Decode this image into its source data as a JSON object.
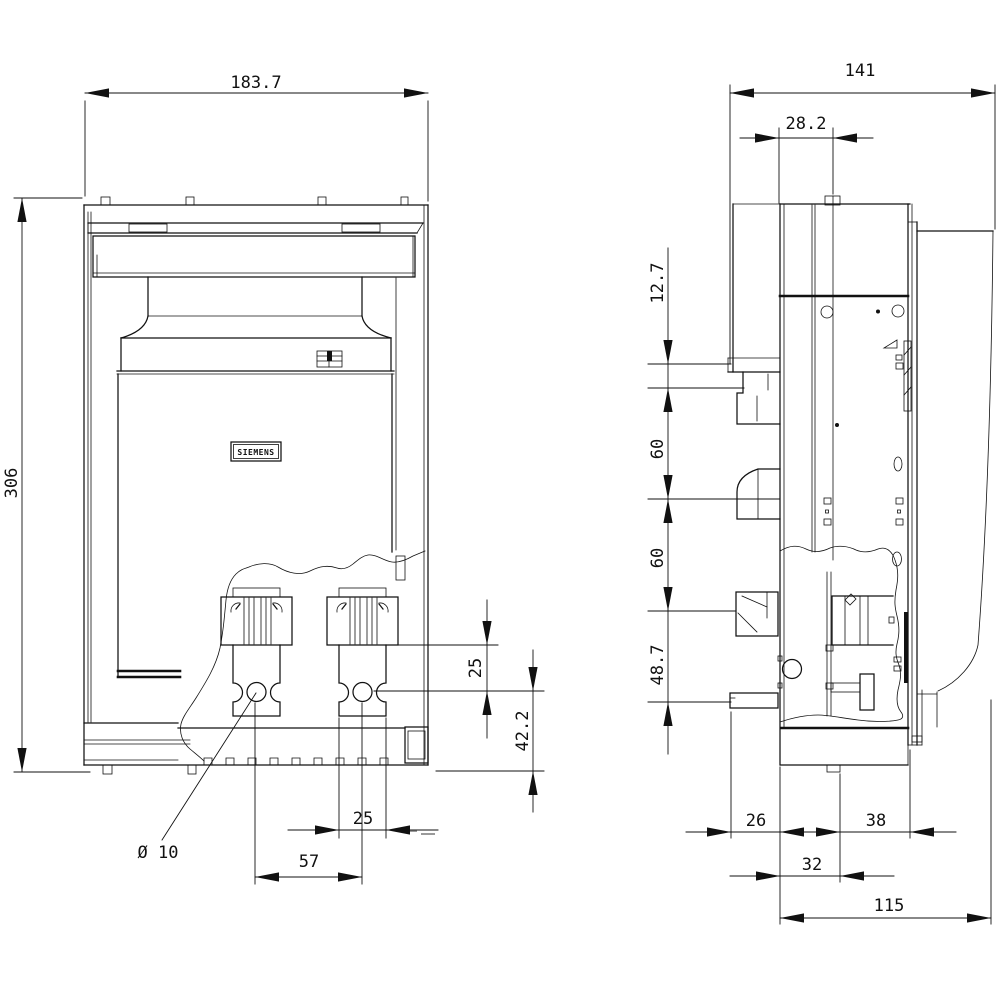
{
  "drawing": {
    "brand_label": "SIEMENS",
    "front_view": {
      "overall_width": "183.7",
      "overall_height": "306",
      "terminal_width": "25",
      "terminal_pitch": "57",
      "hole_diameter_label": "Ø 10",
      "block_to_hole": "25",
      "hole_to_bottom": "42.2"
    },
    "side_view": {
      "overall_depth": "141",
      "handle_offset": "28.2",
      "top_terminal_offset": "12.7",
      "terminal_spacing_upper": "60",
      "terminal_spacing_lower": "60",
      "bottom_terminal_offset": "48.7",
      "base_front_offset": "26",
      "base_rear_offset": "38",
      "base_slot_width": "32",
      "mounting_depth": "115"
    }
  }
}
